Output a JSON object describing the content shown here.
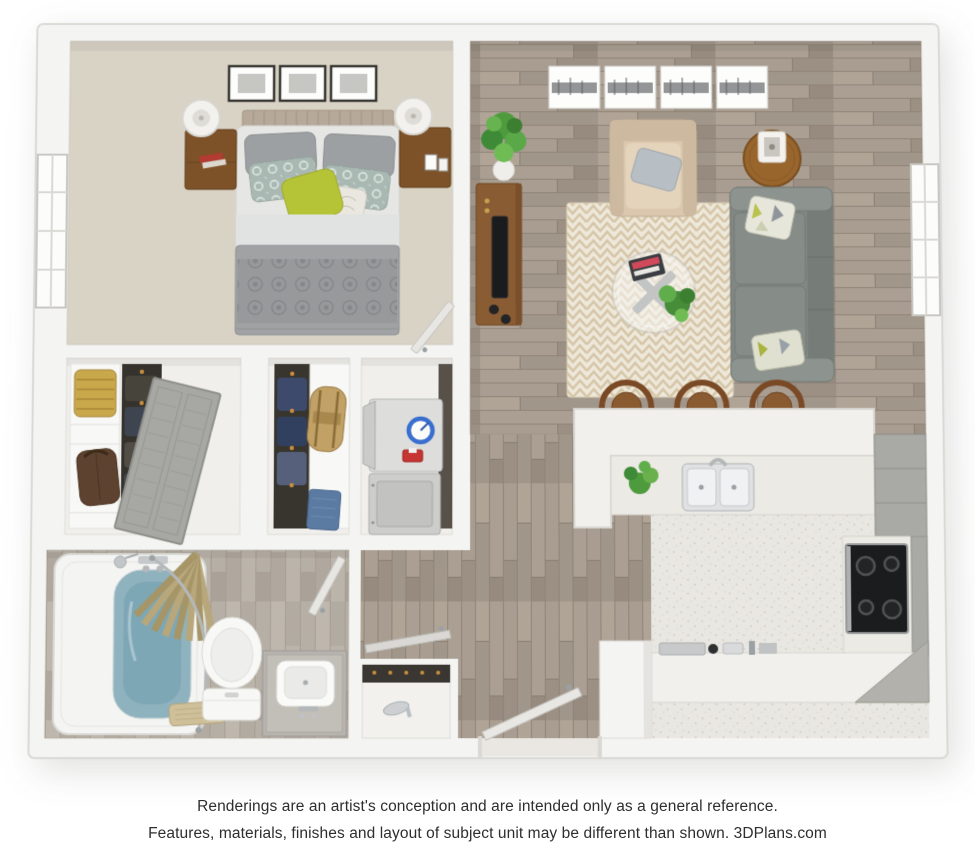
{
  "footer": {
    "line1": "Renderings are an artist's conception and are intended only as a general reference.",
    "line2": "Features, materials, finishes and layout of subject unit may be different than shown. 3DPlans.com",
    "brand": "3DPlans.com"
  },
  "colors": {
    "background": "#ffffff",
    "wall": "#f4f4f2",
    "wall_edge": "#dad9d5",
    "bedroom_carpet": "#d9d3c6",
    "wood_floor": "#a69b8e",
    "bathroom_floor": "#b8b1a7",
    "kitchen_floor": "#e9e7e1",
    "counter_white": "#f1f0ec",
    "cabinet_gray": "#a9a9a5",
    "stove_black": "#1b1c1e",
    "sofa_gray": "#818783",
    "armchair_beige": "#dac7ae",
    "rug_cream": "#eee8da",
    "rug_chevron_tan": "#d6c6a8",
    "accent_green_pillow": "#b5c437",
    "furniture_wood_brown": "#7d5229",
    "bathtub_water_blue": "#8fb2bf",
    "shower_curtain_khaki": "#b7a77a",
    "washer_dial_blue": "#3a6fd0",
    "detergent_red": "#c63532",
    "plant_green": "#4e9b3e",
    "caption_text": "#2e2e2e"
  },
  "scene": {
    "type": "3d-floor-plan-top-view",
    "unit": "one-bedroom apartment",
    "rooms": [
      {
        "name": "bedroom",
        "floor": "carpet",
        "furniture": [
          "queen-bed",
          "tufted-headboard",
          "gray-pillows",
          "sage-damask-pillows",
          "green-accent-pillow",
          "patterned-duvet",
          "nightstand-left",
          "nightstand-right",
          "white-table-lamps",
          "three-framed-pictures",
          "window-left-wall",
          "bedroom-door"
        ]
      },
      {
        "name": "living-room",
        "floor": "wood",
        "furniture": [
          "gray-sofa",
          "geometric-throw-pillows",
          "beige-armchair",
          "gray-throw-pillow",
          "round-side-table",
          "cube-lamp",
          "tv-stand",
          "tv",
          "corner-potted-plant",
          "four-panel-skyline-art",
          "chevron-rug",
          "round-glass-coffee-table",
          "coffee-table-books",
          "coffee-table-plant",
          "window-right-wall"
        ]
      },
      {
        "name": "kitchen",
        "floor": "speckled-tile",
        "furniture": [
          "u-shaped-counter",
          "breakfast-bar",
          "three-bar-stools",
          "double-sink",
          "faucet",
          "counter-plant",
          "black-cooktop-stove",
          "gray-cabinets",
          "corner-cabinet",
          "small-appliances"
        ]
      },
      {
        "name": "bathroom",
        "floor": "wood",
        "furniture": [
          "bathtub",
          "shower-curtain",
          "curved-shower-rod",
          "shower-head",
          "toilet",
          "vanity-with-sink",
          "bath-mat",
          "bathroom-door"
        ]
      },
      {
        "name": "closet-left",
        "furniture": [
          "shelf-column",
          "woven-basket",
          "leather-bag",
          "hanging-clothes",
          "louvered-closet-door"
        ]
      },
      {
        "name": "closet-middle",
        "furniture": [
          "hanging-clothes",
          "duffel-bag",
          "folded-jeans",
          "shelf-column"
        ]
      },
      {
        "name": "laundry-closet",
        "furniture": [
          "stacked-washer-dryer",
          "detergent-box"
        ]
      },
      {
        "name": "entry",
        "floor": "wood",
        "furniture": [
          "front-door",
          "shoe-closet",
          "silver-high-heels",
          "shoe-closet-door"
        ]
      },
      {
        "name": "hallway",
        "floor": "wood",
        "furniture": []
      }
    ]
  }
}
